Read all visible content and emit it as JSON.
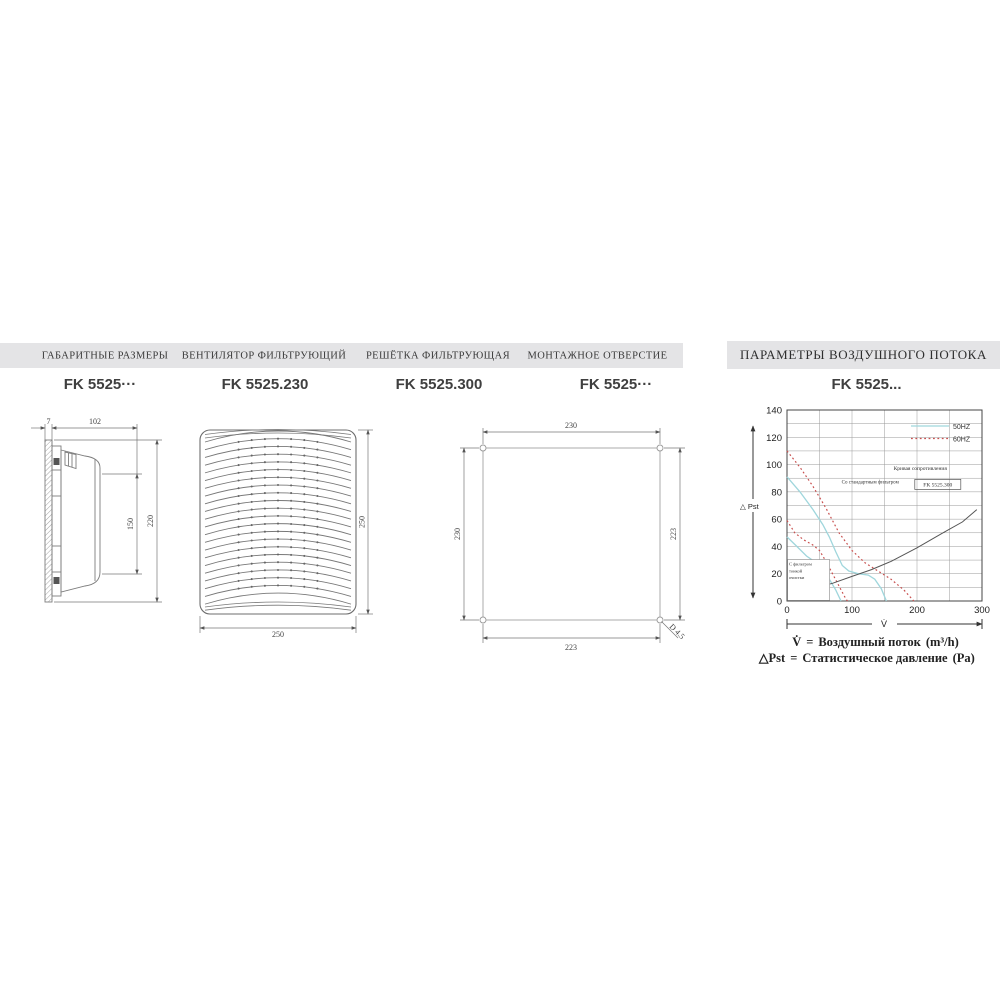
{
  "header": {
    "left_columns": [
      {
        "title": "ГАБАРИТНЫЕ РАЗМЕРЫ",
        "model": "FK 5525···"
      },
      {
        "title": "ВЕНТИЛЯТОР ФИЛЬТРУЮЩИЙ",
        "model": "FK 5525.230"
      },
      {
        "title": "РЕШЁТКА ФИЛЬТРУЮЩАЯ",
        "model": "FK 5525.300"
      },
      {
        "title": "МОНТАЖНОЕ ОТВЕРСТИЕ",
        "model": "FK 5525···"
      }
    ],
    "right": {
      "title": "ПАРАМЕТРЫ ВОЗДУШНОГО ПОТОКА",
      "model": "FK 5525..."
    }
  },
  "drawings": {
    "side_view": {
      "dims": {
        "panel_thickness": "7",
        "depth": "102",
        "inner_height": "150",
        "outer_height": "220"
      }
    },
    "fan_grille": {
      "dims": {
        "height": "250",
        "width": "250"
      }
    },
    "mounting_cutout": {
      "dims": {
        "top_width": "230",
        "left_height": "230",
        "right_height": "223",
        "bottom_width": "223",
        "hole_diameter": "D 4.5"
      }
    }
  },
  "chart_data": {
    "type": "line",
    "title": "FK 5525...",
    "xlabel": "V̇",
    "ylabel": "△ Pst",
    "xlim": [
      0,
      300
    ],
    "ylim": [
      0,
      140
    ],
    "x_ticks": [
      0,
      100,
      200,
      300
    ],
    "y_ticks": [
      0,
      20,
      40,
      60,
      80,
      100,
      120,
      140
    ],
    "x_grid_step": 50,
    "y_grid_step": 10,
    "grid_color": "#9a9a9a",
    "legend": {
      "position": "top-right",
      "entries": [
        {
          "label": "50HZ",
          "style": "solid",
          "color": "#9fd6dc"
        },
        {
          "label": "60HZ",
          "style": "dotted",
          "color": "#c8504f"
        }
      ]
    },
    "series": [
      {
        "name": "50HZ — со стандартным фильтром",
        "color": "#9fd6dc",
        "style": "solid",
        "width": 1.3,
        "points": [
          [
            0,
            91
          ],
          [
            20,
            80
          ],
          [
            40,
            67
          ],
          [
            55,
            56
          ],
          [
            65,
            47
          ],
          [
            75,
            36
          ],
          [
            85,
            26
          ],
          [
            95,
            22
          ],
          [
            110,
            20
          ],
          [
            125,
            19
          ],
          [
            135,
            16
          ],
          [
            145,
            9
          ],
          [
            153,
            0
          ]
        ]
      },
      {
        "name": "60HZ — со стандартным фильтром",
        "color": "#c8504f",
        "style": "dotted",
        "width": 1.2,
        "points": [
          [
            0,
            110
          ],
          [
            20,
            98
          ],
          [
            40,
            84
          ],
          [
            60,
            68
          ],
          [
            80,
            50
          ],
          [
            100,
            37
          ],
          [
            120,
            28
          ],
          [
            140,
            22
          ],
          [
            160,
            16
          ],
          [
            180,
            8
          ],
          [
            195,
            0
          ]
        ]
      },
      {
        "name": "50HZ — с фильтром тонкой очистки",
        "color": "#9fd6dc",
        "style": "solid",
        "width": 1.3,
        "points": [
          [
            0,
            47
          ],
          [
            15,
            40
          ],
          [
            30,
            33
          ],
          [
            45,
            28
          ],
          [
            55,
            24
          ],
          [
            65,
            16
          ],
          [
            75,
            8
          ],
          [
            83,
            0
          ]
        ]
      },
      {
        "name": "60HZ — с фильтром тонкой очистки",
        "color": "#c8504f",
        "style": "dotted",
        "width": 1.2,
        "points": [
          [
            0,
            59
          ],
          [
            12,
            50
          ],
          [
            25,
            45
          ],
          [
            40,
            41
          ],
          [
            50,
            37
          ],
          [
            60,
            29
          ],
          [
            70,
            20
          ],
          [
            80,
            11
          ],
          [
            90,
            2
          ],
          [
            93,
            0
          ]
        ]
      },
      {
        "name": "Кривая сопротивления FK 5525.300",
        "color": "#555555",
        "style": "solid",
        "width": 1,
        "points": [
          [
            45,
            10
          ],
          [
            70,
            13
          ],
          [
            100,
            18
          ],
          [
            130,
            23
          ],
          [
            160,
            29
          ],
          [
            200,
            39
          ],
          [
            240,
            50
          ],
          [
            270,
            58
          ],
          [
            292,
            67
          ]
        ]
      }
    ],
    "annotations": [
      {
        "text": "Со стандартным фильтром",
        "x": 128,
        "y": 86,
        "anchor": "middle",
        "size": 5
      },
      {
        "text": "Кривая сопротивления",
        "x": 205,
        "y": 96,
        "anchor": "middle",
        "size": 5.5
      },
      {
        "text": "FK 5525.300",
        "x": 232,
        "y": 84,
        "anchor": "middle",
        "size": 5.5,
        "frame": "box",
        "fw": 46,
        "fh": 10
      },
      {
        "text": "С фильтром тонкой очистки",
        "lines": [
          "С фильтром",
          "тонкой",
          "очистки"
        ],
        "x": 3,
        "y": 26,
        "anchor": "start",
        "size": 4.5,
        "line_height": 6.8,
        "frame": "bg",
        "fw": 42
      }
    ]
  },
  "notes": [
    {
      "symbol": "V̇",
      "rel": "=",
      "text": "Воздушный поток",
      "unit": "(m³/h)"
    },
    {
      "symbol": "△Pst",
      "rel": "=",
      "text": "Статистическое давление",
      "unit": "(Pa)"
    }
  ],
  "colors": {
    "header_bg": "#e4e4e6",
    "line_50hz": "#9fd6dc",
    "line_60hz": "#c8504f",
    "resistance_curve": "#555555",
    "drawing_stroke": "#7d7d7d"
  }
}
